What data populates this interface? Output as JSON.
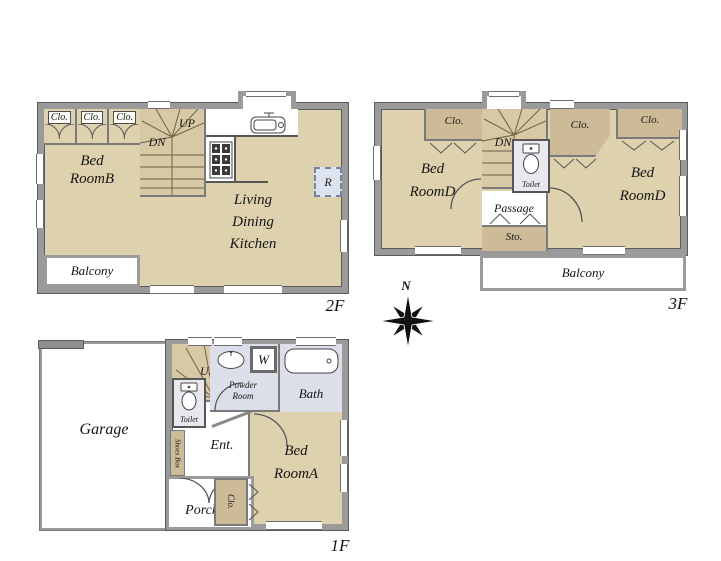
{
  "floor2": {
    "floor_label": "2F",
    "closets": [
      "Clo.",
      "Clo.",
      "Clo."
    ],
    "bedroom_b": "Bed\nRoomB",
    "stairs_down": "DN",
    "stairs_up": "UP",
    "living_dining_kitchen": "Living\nDining\nKitchen",
    "refrigerator": "R",
    "balcony": "Balcony"
  },
  "floor3": {
    "floor_label": "3F",
    "closet_left": "Clo.",
    "closet_middle": "Clo.",
    "closet_right": "Clo.",
    "bedroom_d_left": "Bed\nRoomD",
    "bedroom_d_right": "Bed\nRoomD",
    "stairs_down": "DN",
    "toilet": "Toilet",
    "passage": "Passage",
    "storage": "Sto.",
    "balcony": "Balcony"
  },
  "floor1": {
    "floor_label": "1F",
    "garage": "Garage",
    "stairs_up": "UP",
    "toilet": "Toilet",
    "shoes_box": "Shoes Box",
    "entrance": "Ent.",
    "porch": "Porch",
    "powder_room": "Powder\nRoom",
    "washer": "W",
    "bath": "Bath",
    "bedroom_a": "Bed\nRoomA",
    "closet": "Clo."
  },
  "compass": {
    "north_label": "N"
  },
  "colors": {
    "wall_gray": "#9a9a9a",
    "wall_line": "#5c5c5c",
    "room_tan": "#ddd1ae",
    "closet_tan": "#cdbb98",
    "stair_tan": "#d8c9a5",
    "wet_area_blue": "#dcdfe9",
    "toilet_floor_gray": "#e8e8ee",
    "refrigerator_blue": "#dde3ef",
    "background": "#ffffff"
  },
  "icons": {
    "kitchen_sink": "kitchen-sink-icon",
    "stove": "stove-icon",
    "toilet": "toilet-icon",
    "washbasin": "washbasin-icon",
    "bathtub": "bathtub-icon",
    "washing_machine": "washing-machine-box",
    "swing_door": "swing-door-icon",
    "folding_door": "folding-door-icon",
    "compass_rose": "compass-rose-icon"
  }
}
